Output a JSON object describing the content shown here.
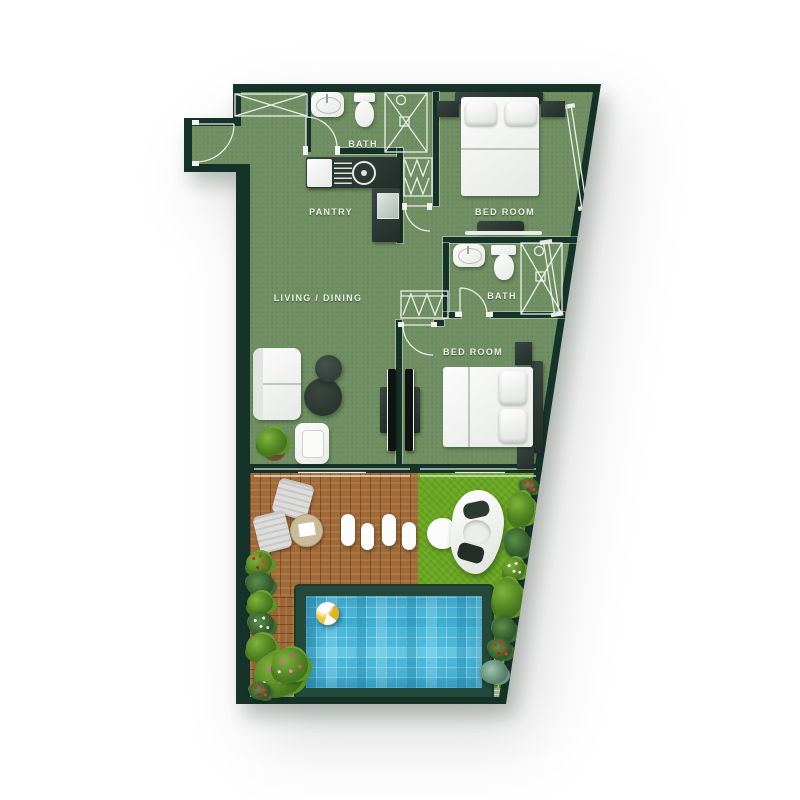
{
  "rooms": {
    "bath_top": {
      "label": "BATH",
      "fixtures": [
        "wash-basin",
        "toilet",
        "shower"
      ]
    },
    "pantry": {
      "label": "PANTRY",
      "fixtures": [
        "kitchen-counter",
        "fridge",
        "cooktop",
        "kitchen-sink"
      ]
    },
    "bedroom_top": {
      "label": "BED ROOM",
      "fixtures": [
        "double-bed",
        "nightstand",
        "nightstand",
        "tv-console",
        "wardrobe"
      ]
    },
    "living_dining": {
      "label": "LIVING / DINING",
      "fixtures": [
        "sofa",
        "armchair",
        "coffee-table",
        "side-table",
        "potted-plant",
        "tv"
      ]
    },
    "bath_mid": {
      "label": "BATH",
      "fixtures": [
        "wash-basin",
        "toilet",
        "shower"
      ]
    },
    "bedroom_mid": {
      "label": "BED ROOM",
      "fixtures": [
        "double-bed",
        "nightstand",
        "nightstand",
        "wardrobe",
        "tv"
      ]
    }
  },
  "entry": {
    "features": [
      "entrance-door",
      "closet"
    ]
  },
  "outdoor": {
    "features": [
      "timber-deck",
      "deck-chairs",
      "round-table",
      "stepping-stones",
      "lawn",
      "lounge-pod",
      "ottoman",
      "swimming-pool",
      "beach-ball",
      "planting-border",
      "stone-path"
    ]
  },
  "colors": {
    "wall": "#16332a",
    "floor": "#6f8e61",
    "grass": "#68a51f",
    "deck_wood": "#a16a39",
    "pool_water": "#49b7d9",
    "pool_frame": "#24493a",
    "label_text": "#eef2e8"
  }
}
